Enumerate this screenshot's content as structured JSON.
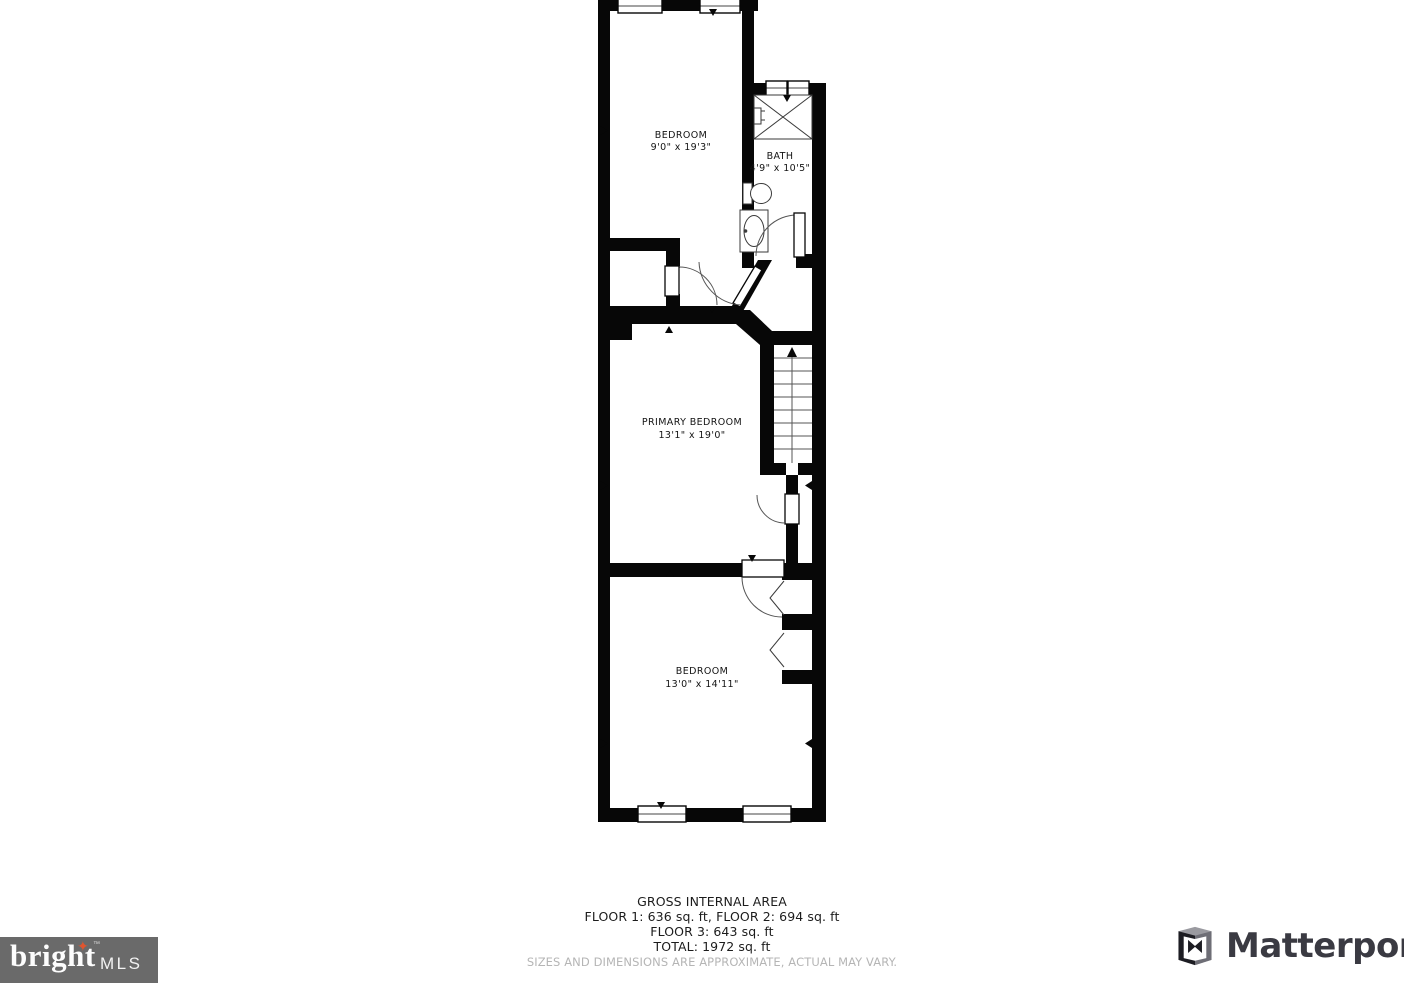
{
  "plan": {
    "rooms": [
      {
        "name": "BEDROOM",
        "dims": "9'0\" x 19'3\""
      },
      {
        "name": "BATH",
        "dims": "4'9\" x 10'5\""
      },
      {
        "name": "PRIMARY BEDROOM",
        "dims": "13'1\" x 19'0\""
      },
      {
        "name": "BEDROOM",
        "dims": "13'0\" x 14'11\""
      }
    ],
    "stairs_direction": "up"
  },
  "footer": {
    "title": "GROSS INTERNAL AREA",
    "line1": "FLOOR 1: 636 sq. ft, FLOOR 2: 694 sq. ft",
    "line2": "FLOOR 3: 643 sq. ft",
    "line3": "TOTAL: 1972 sq. ft",
    "disclaimer": "SIZES AND DIMENSIONS ARE APPROXIMATE, ACTUAL MAY VARY."
  },
  "logos": {
    "bright": {
      "text": "bright",
      "tm": "™",
      "suffix": "MLS",
      "bg": "#6a6a6a",
      "accent": "#e0552f"
    },
    "matterport": {
      "text": "Matterport",
      "color": "#3a3a42"
    }
  }
}
